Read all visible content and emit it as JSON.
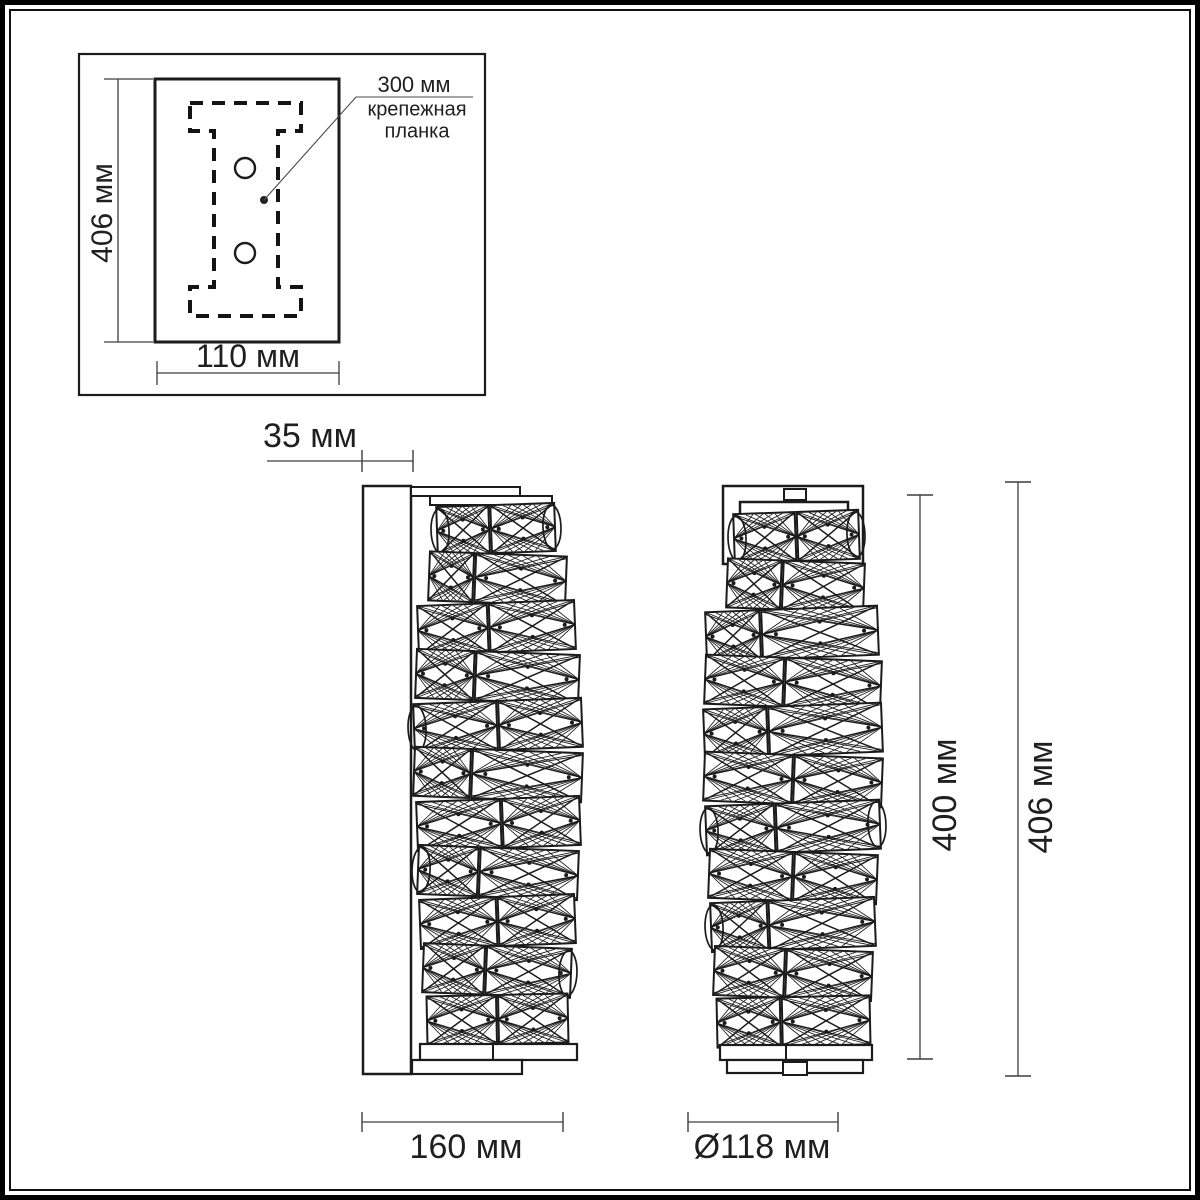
{
  "labels": {
    "depth": "35 мм",
    "inset_height": "406 мм",
    "inset_width": "110 мм",
    "callout_value": "300 мм",
    "callout_name": "крепежная планка",
    "body_width": "160 мм",
    "diameter": "Ø118 мм",
    "body_height": "400 мм",
    "total_height": "406 мм"
  },
  "colors": {
    "line": "#1b1b1b",
    "dim": "#3d3d3d",
    "text": "#1f1f1f",
    "background": "#ffffff"
  },
  "diagram": {
    "inset": {
      "box": [
        79,
        54,
        406,
        341
      ],
      "plate_rect": [
        155,
        79,
        184,
        263
      ],
      "ibeam_path": "M190,103 H301 V131 H278 V287 H301 V316 H190 V287 H214 V131 H190 Z",
      "holes": [
        [
          245,
          168,
          10
        ],
        [
          245,
          253,
          10
        ]
      ],
      "leader_dot": [
        264,
        200,
        4
      ],
      "leader_points": "264,200 356,97 473,97",
      "vdim_line": [
        118,
        79,
        118,
        342
      ],
      "vdim_ext": [
        [
          104,
          79,
          153,
          79
        ],
        [
          104,
          342,
          153,
          342
        ]
      ],
      "hdim_line": [
        157,
        373,
        339,
        373
      ],
      "hdim_ticks": [
        [
          157,
          361,
          157,
          385
        ],
        [
          339,
          361,
          339,
          385
        ]
      ]
    },
    "dims": [
      {
        "name": "depth",
        "line": [
          267,
          461,
          413,
          461
        ],
        "ticks": [
          [
            362,
            450,
            362,
            472
          ],
          [
            413,
            450,
            413,
            472
          ]
        ]
      },
      {
        "name": "body-width",
        "line": [
          362,
          1122,
          563,
          1122
        ],
        "ticks": [
          [
            362,
            1112,
            362,
            1132
          ],
          [
            563,
            1112,
            563,
            1132
          ]
        ]
      },
      {
        "name": "diameter",
        "line": [
          688,
          1122,
          838,
          1122
        ],
        "ticks": [
          [
            688,
            1112,
            688,
            1132
          ],
          [
            838,
            1112,
            838,
            1132
          ]
        ]
      },
      {
        "name": "body-height",
        "line": [
          920,
          495,
          920,
          1059
        ],
        "ticks": [
          [
            907,
            495,
            933,
            495
          ],
          [
            907,
            1059,
            933,
            1059
          ]
        ]
      },
      {
        "name": "total-height",
        "line": [
          1018,
          482,
          1018,
          1076
        ],
        "ticks": [
          [
            1005,
            482,
            1031,
            482
          ],
          [
            1005,
            1076,
            1031,
            1076
          ]
        ]
      }
    ],
    "side_view": {
      "plate": [
        363,
        486,
        48,
        588
      ],
      "bars": [
        [
          411,
          487,
          109,
          9
        ],
        [
          430,
          496,
          122,
          9
        ]
      ],
      "base": [
        [
          420,
          1044,
          157,
          16
        ],
        [
          412,
          1060,
          110,
          14
        ]
      ],
      "base_divider_x": 493,
      "rows": [
        {
          "y": 505,
          "h": 48,
          "x": 437,
          "w": 118,
          "tilt": -2.0,
          "split": 0.45,
          "caps": "both"
        },
        {
          "y": 554,
          "h": 49,
          "x": 429,
          "w": 137,
          "tilt": 2.2,
          "split": 0.33,
          "caps": ""
        },
        {
          "y": 603,
          "h": 49,
          "x": 418,
          "w": 157,
          "tilt": -2.2,
          "split": 0.45,
          "caps": ""
        },
        {
          "y": 652,
          "h": 49,
          "x": 416,
          "w": 163,
          "tilt": 2.2,
          "split": 0.36,
          "caps": ""
        },
        {
          "y": 701,
          "h": 49,
          "x": 414,
          "w": 168,
          "tilt": -2.2,
          "split": 0.5,
          "caps": "left"
        },
        {
          "y": 750,
          "h": 49,
          "x": 414,
          "w": 168,
          "tilt": 2.2,
          "split": 0.34,
          "caps": ""
        },
        {
          "y": 799,
          "h": 49,
          "x": 417,
          "w": 163,
          "tilt": -2.2,
          "split": 0.52,
          "caps": ""
        },
        {
          "y": 848,
          "h": 49,
          "x": 418,
          "w": 160,
          "tilt": 2.2,
          "split": 0.38,
          "caps": "left"
        },
        {
          "y": 897,
          "h": 49,
          "x": 420,
          "w": 155,
          "tilt": -2.2,
          "split": 0.5,
          "caps": ""
        },
        {
          "y": 946,
          "h": 49,
          "x": 423,
          "w": 148,
          "tilt": 2.2,
          "split": 0.42,
          "caps": "right"
        },
        {
          "y": 995,
          "h": 49,
          "x": 427,
          "w": 141,
          "tilt": -1.2,
          "split": 0.5,
          "caps": ""
        }
      ]
    },
    "front_view": {
      "bracket": [
        723,
        486,
        140,
        78
      ],
      "tab_top": [
        784,
        489,
        22,
        11
      ],
      "panel": [
        740,
        502,
        108,
        55
      ],
      "base": [
        [
          720,
          1045,
          152,
          15
        ],
        [
          727,
          1060,
          136,
          13
        ]
      ],
      "base_divider_x": 786,
      "tab_bottom": [
        783,
        1062,
        24,
        13
      ],
      "rows": [
        {
          "y": 512,
          "h": 49,
          "x": 734,
          "w": 125,
          "tilt": -2.0,
          "split": 0.5,
          "caps": "both"
        },
        {
          "y": 561,
          "h": 49,
          "x": 727,
          "w": 137,
          "tilt": 2.2,
          "split": 0.4,
          "caps": ""
        },
        {
          "y": 609,
          "h": 49,
          "x": 706,
          "w": 172,
          "tilt": -2.2,
          "split": 0.32,
          "caps": ""
        },
        {
          "y": 658,
          "h": 49,
          "x": 705,
          "w": 176,
          "tilt": 2.2,
          "split": 0.45,
          "caps": ""
        },
        {
          "y": 706,
          "h": 49,
          "x": 704,
          "w": 178,
          "tilt": -2.2,
          "split": 0.36,
          "caps": ""
        },
        {
          "y": 755,
          "h": 49,
          "x": 704,
          "w": 178,
          "tilt": 2.2,
          "split": 0.5,
          "caps": ""
        },
        {
          "y": 803,
          "h": 49,
          "x": 706,
          "w": 174,
          "tilt": -2.2,
          "split": 0.4,
          "caps": "both"
        },
        {
          "y": 852,
          "h": 49,
          "x": 709,
          "w": 168,
          "tilt": 2.2,
          "split": 0.5,
          "caps": ""
        },
        {
          "y": 900,
          "h": 49,
          "x": 711,
          "w": 164,
          "tilt": -2.2,
          "split": 0.35,
          "caps": "left"
        },
        {
          "y": 949,
          "h": 49,
          "x": 714,
          "w": 158,
          "tilt": 2.2,
          "split": 0.45,
          "caps": ""
        },
        {
          "y": 997,
          "h": 49,
          "x": 717,
          "w": 153,
          "tilt": -1.2,
          "split": 0.42,
          "caps": ""
        }
      ]
    }
  }
}
